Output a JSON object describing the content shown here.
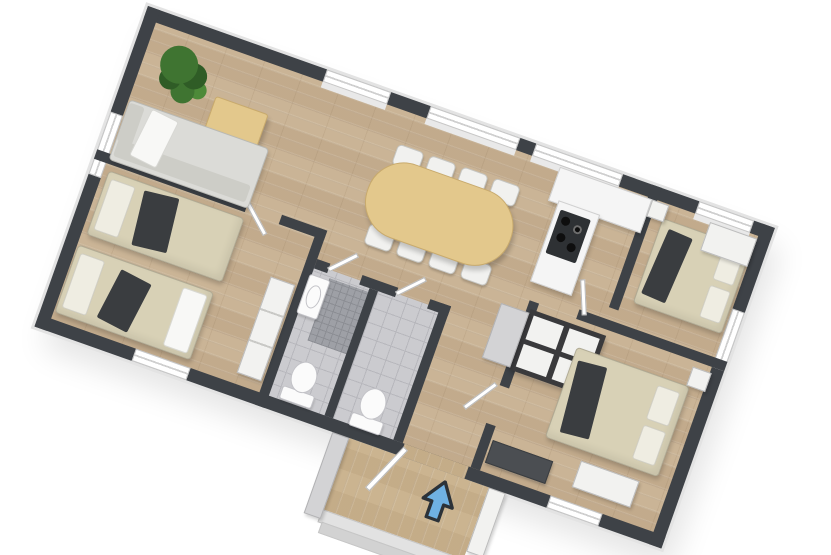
{
  "scene": {
    "type": "3d-floor-plan-top-view",
    "background": "#ffffff",
    "house_rotation_deg": 19.5,
    "entrance_marker": "blue-arrow-pointing-into-house"
  },
  "colors": {
    "wall": "#3e4247",
    "window": "#ffffff",
    "windowFrame": "#c6c6c6",
    "sill": "#e9e9e9",
    "wood": "#c7b193",
    "porchWood": "#c9b28d",
    "tile": "#cbcbcf",
    "grout": "#b7b7bc",
    "mosaic": "#9ea0a6",
    "mosaicDark": "#8c8e94",
    "counter": "#f5f5f5",
    "counterEdge": "#cfcfcf",
    "stove": "#2e3134",
    "burner": "#0e0e0e",
    "bedBeige": "#d8d1b6",
    "pillow": "#efede2",
    "throwDark": "#3a3d40",
    "sofa": "#dbdbd7",
    "sofaBack": "#cdcdc7",
    "whiteFabric": "#f8f8f6",
    "tableWood": "#e3c88c",
    "tableEdge": "#c8aa6d",
    "chair": "#f1f1ef",
    "closetWhite": "#f2f2f0",
    "closetFrame": "#3a3a3c",
    "closetGray": "#d3d3d5",
    "fixture": "#fbfbfb",
    "fixtureShade": "#c3c3c8",
    "plant": "#3f7431",
    "plantDark": "#2f5c26",
    "arrow": "#6fb1e3",
    "arrowOutline": "#2c3238",
    "step": "#e2e2e2",
    "stepDark": "#d2d2d2",
    "door": "#ffffff",
    "doorEdge": "#b9b9b9"
  },
  "rooms": [
    {
      "name": "living-room",
      "furniture": [
        "potted-plant",
        "square-coffee-table",
        "l-shaped-sofa-with-white-throw"
      ]
    },
    {
      "name": "dining-area",
      "furniture": [
        "oval-dining-table",
        "eight-white-chairs"
      ]
    },
    {
      "name": "kitchen",
      "furniture": [
        "l-shaped-counter",
        "cooktop-four-burners"
      ]
    },
    {
      "name": "bedroom-left",
      "furniture": [
        "single-bed-a",
        "single-bed-b",
        "wardrobe-row"
      ]
    },
    {
      "name": "bathroom-1",
      "furniture": [
        "wash-basin",
        "toilet",
        "mosaic-shower"
      ]
    },
    {
      "name": "bathroom-2",
      "furniture": [
        "toilet"
      ]
    },
    {
      "name": "hallway",
      "furniture": [
        "wardrobe-unit",
        "gray-cabinet"
      ]
    },
    {
      "name": "bedroom-top-right",
      "furniture": [
        "double-bed",
        "dresser",
        "nightstand"
      ]
    },
    {
      "name": "bedroom-bottom-right",
      "furniture": [
        "double-bed",
        "bench",
        "tv-console",
        "nightstand"
      ]
    },
    {
      "name": "entrance-porch",
      "furniture": [
        "wood-deck",
        "steps",
        "entrance-arrow"
      ]
    }
  ]
}
